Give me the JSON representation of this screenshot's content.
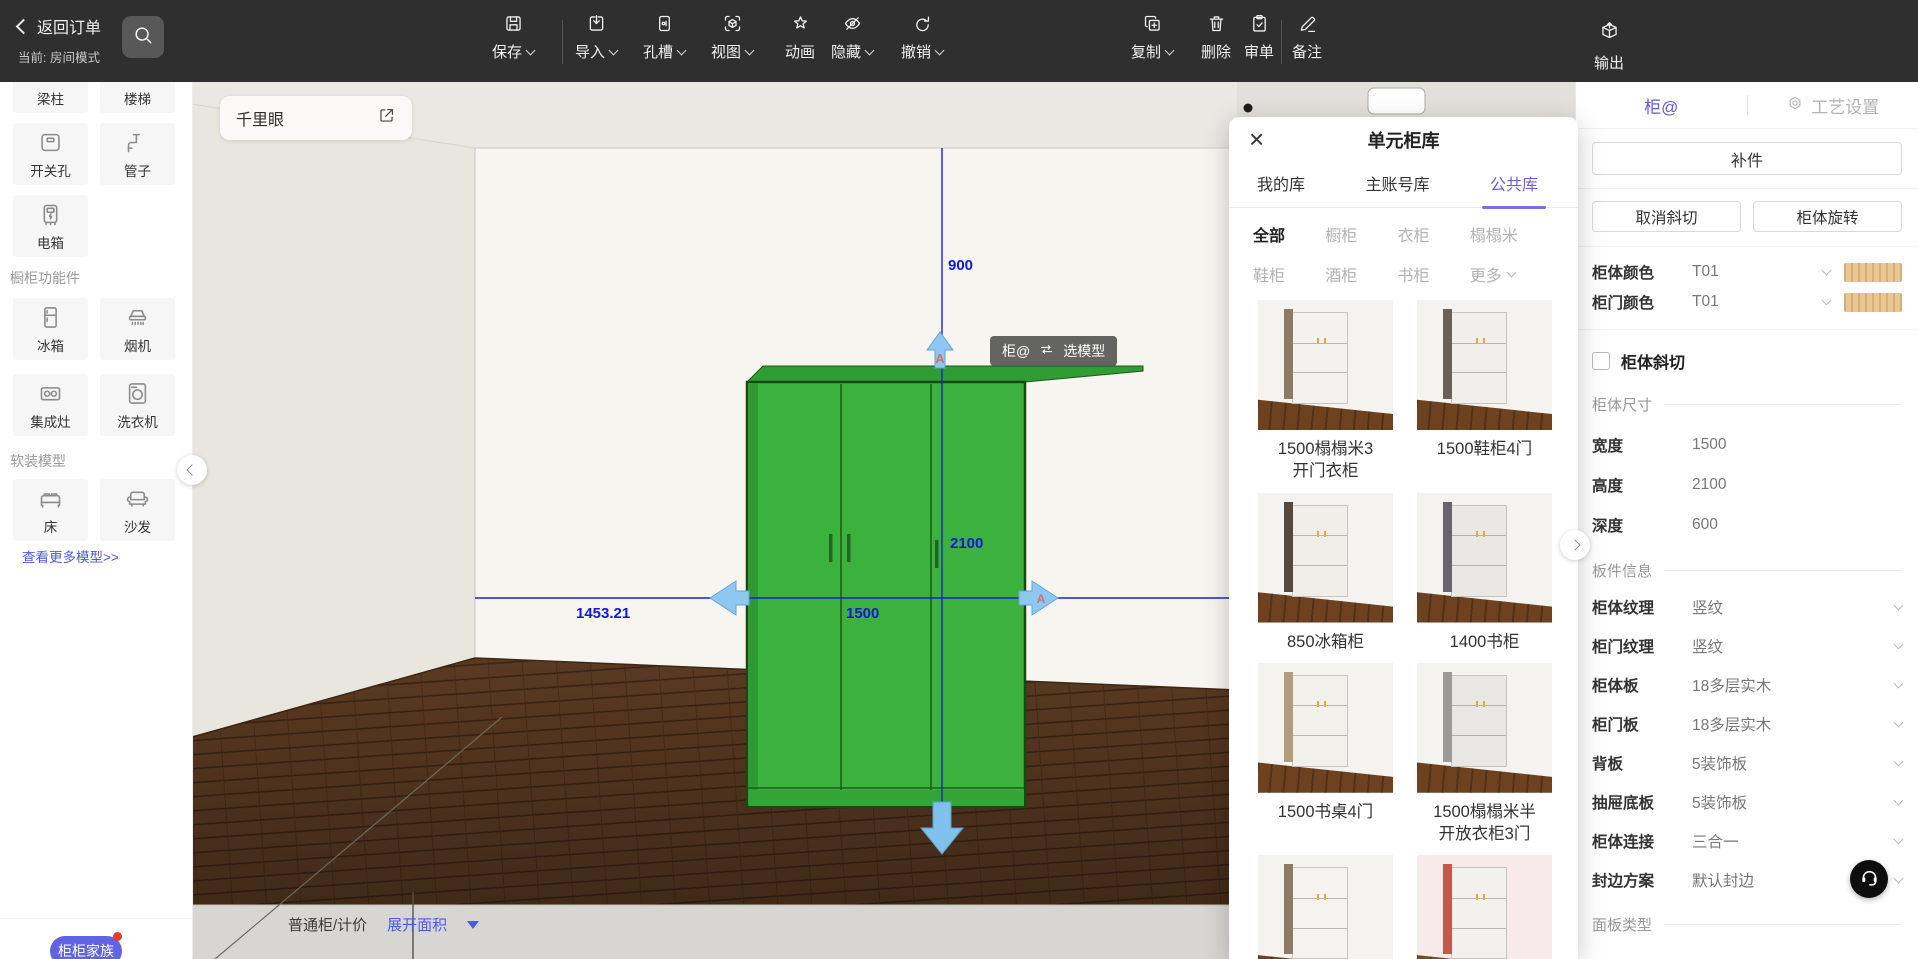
{
  "colors": {
    "accent": "#5d5be6",
    "link": "#4b5be0",
    "dimension": "#1317d9",
    "wardrobe": "#3cb23e",
    "swatch_wood": "#eac792"
  },
  "toolbar": {
    "back_label": "返回订单",
    "mode_label": "当前: 房间模式",
    "buttons": [
      {
        "label": "保存",
        "icon": "save",
        "caret": true,
        "divider_after": true
      },
      {
        "label": "导入",
        "icon": "import",
        "caret": true
      },
      {
        "label": "孔槽",
        "icon": "hole",
        "caret": true
      },
      {
        "label": "视图",
        "icon": "view",
        "caret": true
      },
      {
        "label": "动画",
        "icon": "animation",
        "caret": false
      },
      {
        "label": "隐藏",
        "icon": "hide",
        "caret": true
      },
      {
        "label": "撤销",
        "icon": "undo",
        "caret": true
      },
      {
        "label": "复制",
        "icon": "copy",
        "caret": true
      },
      {
        "label": "删除",
        "icon": "delete",
        "caret": false
      },
      {
        "label": "审单",
        "icon": "review",
        "caret": false,
        "divider_after": true
      },
      {
        "label": "备注",
        "icon": "note",
        "caret": false
      }
    ],
    "export_label": "输出"
  },
  "sidebar": {
    "groups": [
      {
        "header": null,
        "items": [
          {
            "label": "梁柱",
            "icon": "beam"
          },
          {
            "label": "楼梯",
            "icon": "stairs"
          },
          {
            "label": "开关孔",
            "icon": "switch-hole"
          },
          {
            "label": "管子",
            "icon": "pipe"
          },
          {
            "label": "电箱",
            "icon": "electric-box"
          }
        ]
      },
      {
        "header": "橱柜功能件",
        "items": [
          {
            "label": "冰箱",
            "icon": "fridge"
          },
          {
            "label": "烟机",
            "icon": "hood"
          },
          {
            "label": "集成灶",
            "icon": "stove"
          },
          {
            "label": "洗衣机",
            "icon": "washer"
          }
        ]
      },
      {
        "header": "软装模型",
        "items": [
          {
            "label": "床",
            "icon": "bed"
          },
          {
            "label": "沙发",
            "icon": "sofa"
          }
        ]
      }
    ],
    "more_link": "查看更多模型>>",
    "family_button": "柜柜家族"
  },
  "canvas": {
    "panel_title": "千里眼",
    "tooltip": {
      "left": "柜@",
      "right": "选模型"
    },
    "dimensions": {
      "height_above": "900",
      "cabinet_height": "2100",
      "cabinet_width": "1500",
      "wall_distance": "1453.21"
    },
    "bottom_bar": {
      "type_label": "普通柜/计价",
      "area_label": "展开面积"
    }
  },
  "modal": {
    "title": "单元柜库",
    "tabs": [
      {
        "label": "我的库",
        "active": false
      },
      {
        "label": "主账号库",
        "active": false
      },
      {
        "label": "公共库",
        "active": true
      }
    ],
    "categories": [
      {
        "label": "全部",
        "active": true
      },
      {
        "label": "橱柜"
      },
      {
        "label": "衣柜"
      },
      {
        "label": "榻榻米"
      },
      {
        "label": "鞋柜"
      },
      {
        "label": "酒柜"
      },
      {
        "label": "书柜"
      },
      {
        "label": "更多",
        "caret": true
      }
    ],
    "products": [
      {
        "name": "1500榻榻米3",
        "name2": "开门衣柜",
        "cab": "#f3f2ee",
        "side": "#8d7b66",
        "floor": "#6e4221",
        "bg": "#f4f3f0"
      },
      {
        "name": "1500鞋柜4门",
        "name2": "",
        "cab": "#f0efeb",
        "side": "#6b6257",
        "floor": "#6e4221",
        "bg": "#f4f3f0"
      },
      {
        "name": "850冰箱柜",
        "name2": "",
        "cab": "#efeee9",
        "side": "#55493f",
        "floor": "#6e4221",
        "bg": "#f4f3f0"
      },
      {
        "name": "1400书柜",
        "name2": "",
        "cab": "#e9e8e4",
        "side": "#66656b",
        "floor": "#6e4221",
        "bg": "#f4f3f0"
      },
      {
        "name": "1500书桌4门",
        "name2": "",
        "cab": "#f2f0ea",
        "side": "#b39b7d",
        "floor": "#6e4221",
        "bg": "#f4f3f0"
      },
      {
        "name": "1500榻榻米半",
        "name2": "开放衣柜3门",
        "cab": "#e8e7e4",
        "side": "#9a9a98",
        "floor": "#6e4221",
        "bg": "#f4f3f0"
      },
      {
        "name": "",
        "name2": "",
        "cab": "#f4f3ef",
        "side": "#8d7b66",
        "floor": "#6e4221",
        "bg": "#f4f3f0"
      },
      {
        "name": "",
        "name2": "",
        "cab": "#f2f1ed",
        "side": "#c5584a",
        "floor": "#7a4a28",
        "bg": "#f8eaea"
      }
    ]
  },
  "panel": {
    "tab_active": "柜@",
    "tab_settings": "工艺设置",
    "patch_button": "补件",
    "cancel_bevel_button": "取消斜切",
    "rotate_button": "柜体旋转",
    "color_rows": [
      {
        "label": "柜体颜色",
        "value": "T01"
      },
      {
        "label": "柜门颜色",
        "value": "T01"
      }
    ],
    "bevel_checkbox": "柜体斜切",
    "section_size": "柜体尺寸",
    "size_rows": [
      {
        "label": "宽度",
        "value": "1500"
      },
      {
        "label": "高度",
        "value": "2100"
      },
      {
        "label": "深度",
        "value": "600"
      }
    ],
    "section_board": "板件信息",
    "board_rows": [
      {
        "label": "柜体纹理",
        "value": "竖纹"
      },
      {
        "label": "柜门纹理",
        "value": "竖纹"
      },
      {
        "label": "柜体板",
        "value": "18多层实木"
      },
      {
        "label": "柜门板",
        "value": "18多层实木"
      },
      {
        "label": "背板",
        "value": "5装饰板"
      },
      {
        "label": "抽屉底板",
        "value": "5装饰板"
      },
      {
        "label": "柜体连接",
        "value": "三合一"
      },
      {
        "label": "封边方案",
        "value": "默认封边"
      }
    ],
    "section_panel_type": "面板类型"
  }
}
